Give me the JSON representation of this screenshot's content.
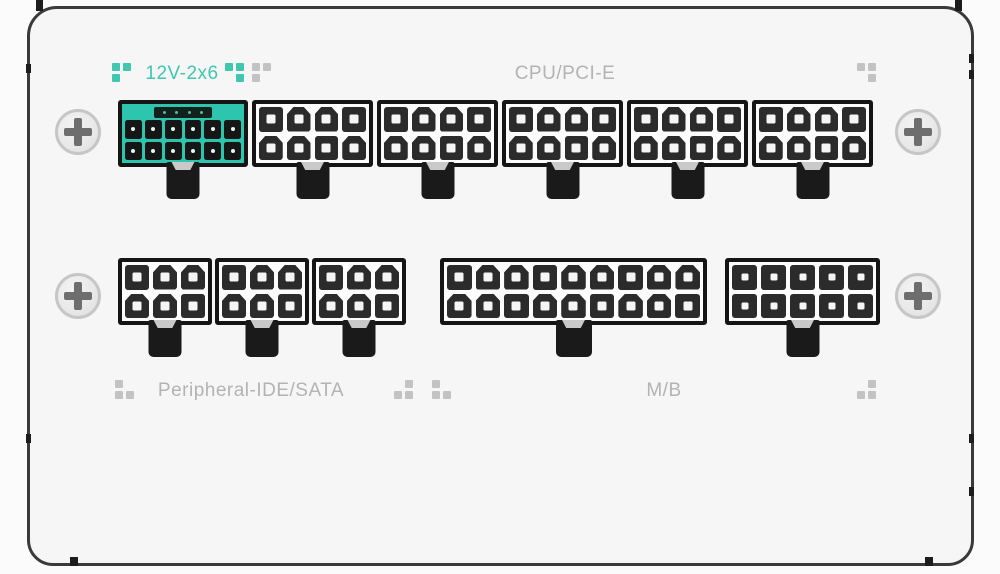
{
  "panel": {
    "labels": {
      "hpwr": "12V-2x6",
      "cpu_pcie": "CPU/PCI-E",
      "peripheral": "Peripheral-IDE/SATA",
      "motherboard": "M/B"
    },
    "colors": {
      "accent_teal": "#3fc7b0",
      "teal_fill": "#2ec5ae",
      "slot_dark": "#13211d",
      "label_gray": "#b3b3b3",
      "pattern_gray": "#c3c3c3",
      "connector_outline": "#151515",
      "connector_body": "#fcfcfc",
      "pin_dark": "#2b2b2b",
      "tab_black": "#1a1a1a",
      "panel_bg": "#f6f6f6",
      "screw_ring": "#c6c6c6",
      "screw_cross": "#6e6e6e"
    }
  },
  "connectors": [
    {
      "key": "hpwr",
      "group_label": "12V-2x6",
      "rows": 2,
      "cols": 6,
      "pin_style": "teal",
      "sense_pins": 4
    },
    {
      "key": "cpu1",
      "group_label": "CPU/PCI-E",
      "rows": 2,
      "cols": 4,
      "pin_style": "mixed"
    },
    {
      "key": "cpu2",
      "group_label": "CPU/PCI-E",
      "rows": 2,
      "cols": 4,
      "pin_style": "mixed"
    },
    {
      "key": "cpu3",
      "group_label": "CPU/PCI-E",
      "rows": 2,
      "cols": 4,
      "pin_style": "mixed"
    },
    {
      "key": "cpu4",
      "group_label": "CPU/PCI-E",
      "rows": 2,
      "cols": 4,
      "pin_style": "mixed"
    },
    {
      "key": "cpu5",
      "group_label": "CPU/PCI-E",
      "rows": 2,
      "cols": 4,
      "pin_style": "mixed"
    },
    {
      "key": "per1",
      "group_label": "Peripheral-IDE/SATA",
      "rows": 2,
      "cols": 3,
      "pin_style": "mixed"
    },
    {
      "key": "per2",
      "group_label": "Peripheral-IDE/SATA",
      "rows": 2,
      "cols": 3,
      "pin_style": "mixed"
    },
    {
      "key": "per3",
      "group_label": "Peripheral-IDE/SATA",
      "rows": 2,
      "cols": 3,
      "pin_style": "mixed"
    },
    {
      "key": "mb",
      "group_label": "M/B",
      "rows": 2,
      "cols": 9,
      "pin_style": "mixed"
    },
    {
      "key": "aux",
      "group_label": "",
      "rows": 2,
      "cols": 5,
      "pin_style": "square"
    }
  ],
  "patterns": [
    {
      "key": "tl-a",
      "color": "teal",
      "cells": [
        [
          1,
          1
        ],
        [
          1,
          0
        ]
      ]
    },
    {
      "key": "tl-b",
      "color": "teal",
      "cells": [
        [
          1,
          1
        ],
        [
          0,
          1
        ]
      ]
    },
    {
      "key": "tl-c",
      "color": "gray",
      "cells": [
        [
          1,
          1
        ],
        [
          1,
          0
        ]
      ]
    },
    {
      "key": "tr",
      "color": "gray",
      "cells": [
        [
          1,
          1
        ],
        [
          0,
          1
        ]
      ]
    },
    {
      "key": "bl",
      "color": "gray",
      "cells": [
        [
          1,
          0
        ],
        [
          1,
          1
        ]
      ]
    },
    {
      "key": "bm1",
      "color": "gray",
      "cells": [
        [
          0,
          1
        ],
        [
          1,
          1
        ]
      ]
    },
    {
      "key": "bm2",
      "color": "gray",
      "cells": [
        [
          1,
          0
        ],
        [
          1,
          1
        ]
      ]
    },
    {
      "key": "br",
      "color": "gray",
      "cells": [
        [
          0,
          1
        ],
        [
          1,
          1
        ]
      ]
    }
  ]
}
